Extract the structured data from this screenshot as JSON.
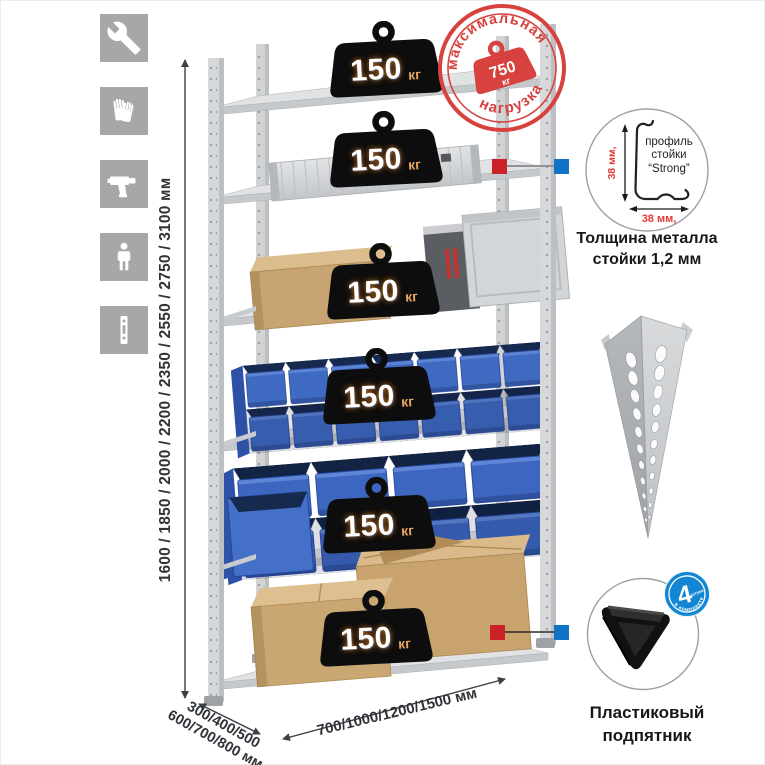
{
  "icons": [
    {
      "name": "wrench"
    },
    {
      "name": "gloves"
    },
    {
      "name": "drill"
    },
    {
      "name": "person"
    },
    {
      "name": "rack-post"
    }
  ],
  "dims": {
    "height": "1600 / 1850 / 2000 / 2200 / 2350 / 2550 / 2750 / 3100 мм",
    "depth1": "300/400/500",
    "depth2": "600/700/800 мм",
    "width": "700/1000/1200/1500 мм"
  },
  "badges": [
    {
      "value": "150",
      "unit": "кг"
    },
    {
      "value": "150",
      "unit": "кг"
    },
    {
      "value": "150",
      "unit": "кг"
    },
    {
      "value": "150",
      "unit": "кг"
    },
    {
      "value": "150",
      "unit": "кг"
    },
    {
      "value": "150",
      "unit": "кг"
    }
  ],
  "stamp": {
    "arc_top": "максимальная",
    "arc_bottom": "нагрузка",
    "value": "750",
    "unit": "кг"
  },
  "profile": {
    "l1": "профиль",
    "l2": "стойки",
    "l3": "“Strong”",
    "dim_v": "38 мм,",
    "dim_h": "38 мм,",
    "cap1": "Толщина металла",
    "cap2": "стойки 1,2 мм"
  },
  "foot": {
    "num": "4",
    "word": "штуки",
    "arc": "в комплекте",
    "cap1": "Пластиковый",
    "cap2": "подпятник"
  },
  "colors": {
    "stamp_red": "#d7423e",
    "accent_red": "#cb2228",
    "accent_blue": "#1173c6",
    "bin_blue": "#3e6ac2",
    "icon_gray": "#a7a7a7"
  }
}
